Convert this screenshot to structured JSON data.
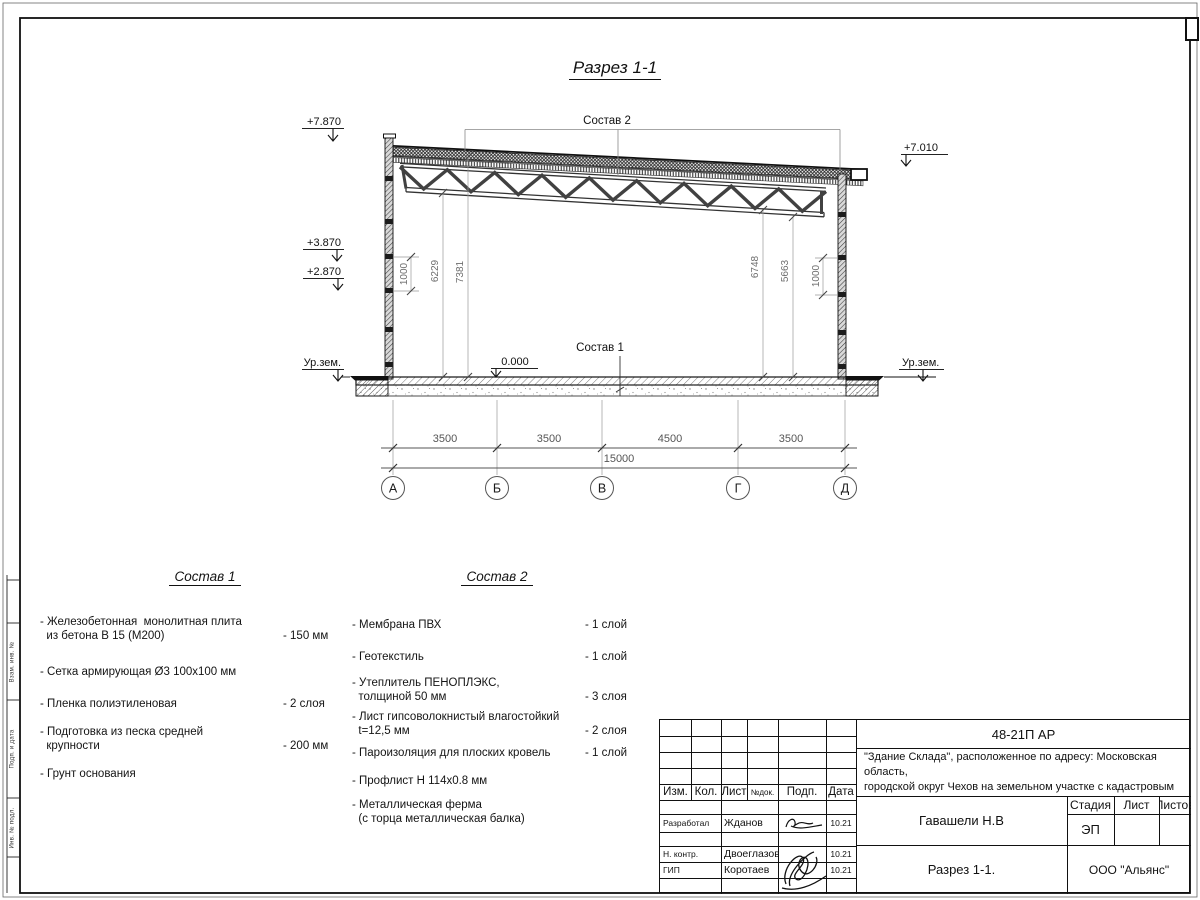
{
  "drawing": {
    "title": "Разрез 1-1",
    "callouts": {
      "roof": "Состав 2",
      "floor": "Состав 1"
    },
    "elevations": {
      "top_left": "+7.870",
      "left_upper": "+3.870",
      "left_lower": "+2.870",
      "ground_left": "Ур.зем.",
      "floor_zero": "0.000",
      "top_right": "+7.010",
      "ground_right": "Ур.зем."
    },
    "vertical_dims": {
      "left_wall_panel": "1000",
      "left_truss_clear": "6229",
      "left_roof_height": "7381",
      "right_truss_clear": "6748",
      "right_ceiling": "5663",
      "right_wall_panel": "1000"
    },
    "bottom_dims": {
      "spans": [
        "3500",
        "3500",
        "4500",
        "3500"
      ],
      "total": "15000"
    },
    "axes": [
      "А",
      "Б",
      "В",
      "Г",
      "Д"
    ]
  },
  "sostav1": {
    "title": "Состав 1",
    "items": [
      {
        "name": "- Железобетонная  монолитная плита\n  из бетона В 15 (М200)",
        "value": "- 150 мм"
      },
      {
        "name": "- Сетка армирующая Ø3 100х100 мм",
        "value": ""
      },
      {
        "name": "- Пленка полиэтиленовая",
        "value": "-  2 слоя"
      },
      {
        "name": "- Подготовка из песка средней\n  крупности",
        "value": "- 200 мм"
      },
      {
        "name": "- Грунт основания",
        "value": ""
      }
    ]
  },
  "sostav2": {
    "title": "Состав 2",
    "items": [
      {
        "name": "- Мембрана ПВХ",
        "value": "- 1 слой"
      },
      {
        "name": "- Геотекстиль",
        "value": "- 1 слой"
      },
      {
        "name": "- Утеплитель ПЕНОПЛЭКС,\n  толщиной 50 мм",
        "value": "- 3 слоя"
      },
      {
        "name": "- Лист гипсоволокнистый влагостойкий\n  t=12,5 мм",
        "value": "- 2 слоя"
      },
      {
        "name": "- Пароизоляция для плоских кровель",
        "value": "- 1 слой"
      },
      {
        "name": "- Профлист Н 114х0.8 мм",
        "value": ""
      },
      {
        "name": "- Металлическая ферма\n  (с торца металлическая балка)",
        "value": ""
      }
    ]
  },
  "titleblock": {
    "code": "48-21П АР",
    "description_line1": "\"Здание Склада\", расположенное по адресу: Московская область,",
    "description_line2": "городской округ Чехов на земельном участке с кадастровым",
    "description_line3_prefix": "номером ",
    "cadastral_number": "50:31:0060205:252",
    "rev_headers": [
      "Изм.",
      "Кол.",
      "Лист",
      "№док.",
      "Подп.",
      "Дата"
    ],
    "rows": [
      {
        "role": "Разработал",
        "name": "Жданов",
        "date": "10.21"
      },
      {
        "role": "Н. контр.",
        "name": "Двоеглазов",
        "date": "10.21"
      },
      {
        "role": "ГИП",
        "name": "Коротаев",
        "date": "10.21"
      }
    ],
    "approver": "Гавашели Н.В",
    "stage_label": "Стадия",
    "sheet_label": "Лист",
    "sheets_label": "Листов",
    "stage_value": "ЭП",
    "doc_title": "Разрез 1-1.",
    "company": "ООО \"Альянс\""
  },
  "side_strip": {
    "labels": [
      "Взам. инв. №",
      "Подп. и дата",
      "Инв. № подл."
    ]
  }
}
